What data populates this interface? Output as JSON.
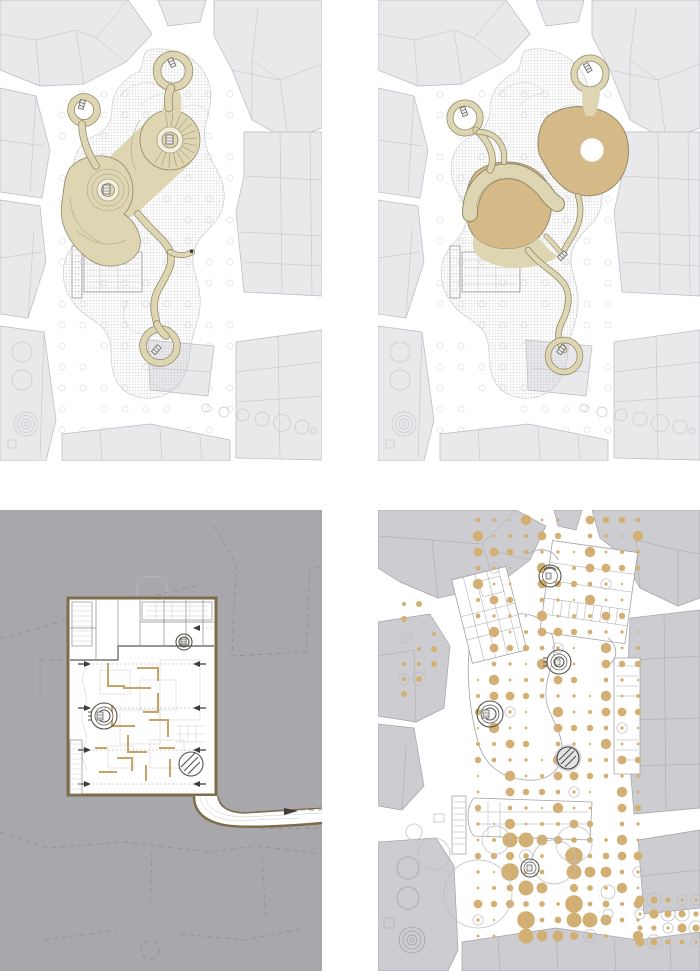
{
  "sheet": {
    "title": "four-panel architectural plan sheet",
    "background": "#ffffff",
    "columns": 2,
    "rows": 2
  },
  "palette": {
    "building-light": "#e9e9ec",
    "building-light-outline": "#b9b9c2",
    "building-mid": "#cdccd1",
    "building-mid-outline": "#a2a2a8",
    "street-circle": "#c7c7cd",
    "faint-line": "#c4c4ca",
    "path-beige": "#ded6b2",
    "path-outline": "#8f8866",
    "contour": "#a39b78",
    "terrace-tan": "#d9ba82",
    "ring-pale": "#f2efe0",
    "gray-bg": "#a8a7ac",
    "dash-outline": "#8e8e93",
    "plan-brown": "#7c6c49",
    "ruin-tan": "#c6a468",
    "dot-tan": "#d2b073",
    "hatch-line": "#b3b3ba"
  },
  "panels": {
    "top_left": {
      "name": "site-plan-paths",
      "background": "#ffffff"
    },
    "top_right": {
      "name": "site-plan-terraces",
      "background": "#ffffff"
    },
    "bottom_left": {
      "name": "underground-excavation-plan",
      "background": "#a8a7ac"
    },
    "bottom_right": {
      "name": "roof-plan-tree-grid",
      "background": "#ffffff"
    }
  },
  "generators": {
    "treeGrid1": {
      "type": "outline",
      "x0": 62,
      "y0": 94,
      "dx": 21,
      "dy": 21,
      "cols": 9,
      "rows": 17,
      "r": 3.1,
      "stroke": "#dadade",
      "skipMod": 4,
      "seed": 0
    },
    "treeGrid2": {
      "type": "outline",
      "x0": 62,
      "y0": 94,
      "dx": 21,
      "dy": 21,
      "cols": 9,
      "rows": 17,
      "r": 3.1,
      "stroke": "#dadade",
      "skipMod": 4,
      "seed": 5
    },
    "fan1": {
      "type": "fan",
      "cx": 170,
      "cy": 140,
      "r1": 13.5,
      "r2": 27.5,
      "a0": -100,
      "a1": 125,
      "step": 16,
      "stroke": "#8f8866",
      "width": 0.5
    },
    "dotMain": {
      "type": "dots",
      "x0": 100,
      "y0": 10,
      "dx": 16,
      "dy": 16,
      "cols": 11,
      "rows": 27,
      "fill": "#d2b073",
      "sizes": [
        1.1,
        1.7,
        2.4,
        3.2,
        4.4,
        2.0,
        1.4,
        5.2
      ],
      "skipMod": 13,
      "ringMod": 17,
      "seed": 2,
      "boost": {
        "x": [
          118,
          242
        ],
        "y": [
          330,
          432
        ],
        "f": 1.7,
        "max": 9
      }
    },
    "dotRight": {
      "type": "dots",
      "x0": 262,
      "y0": 390,
      "dx": 14,
      "dy": 14,
      "cols": 5,
      "rows": 4,
      "fill": "#d2b073",
      "sizes": [
        1.6,
        2.6,
        3.6,
        4.6
      ],
      "skipMod": 0,
      "ringMod": 2,
      "seed": 3
    },
    "dotLeft": {
      "type": "dots",
      "x0": 26,
      "y0": 94,
      "dx": 15,
      "dy": 15,
      "cols": 3,
      "rows": 7,
      "fill": "#d2b073",
      "sizes": [
        1.2,
        2.0,
        3.0
      ],
      "skipMod": 3,
      "ringMod": 7,
      "seed": 4
    }
  }
}
